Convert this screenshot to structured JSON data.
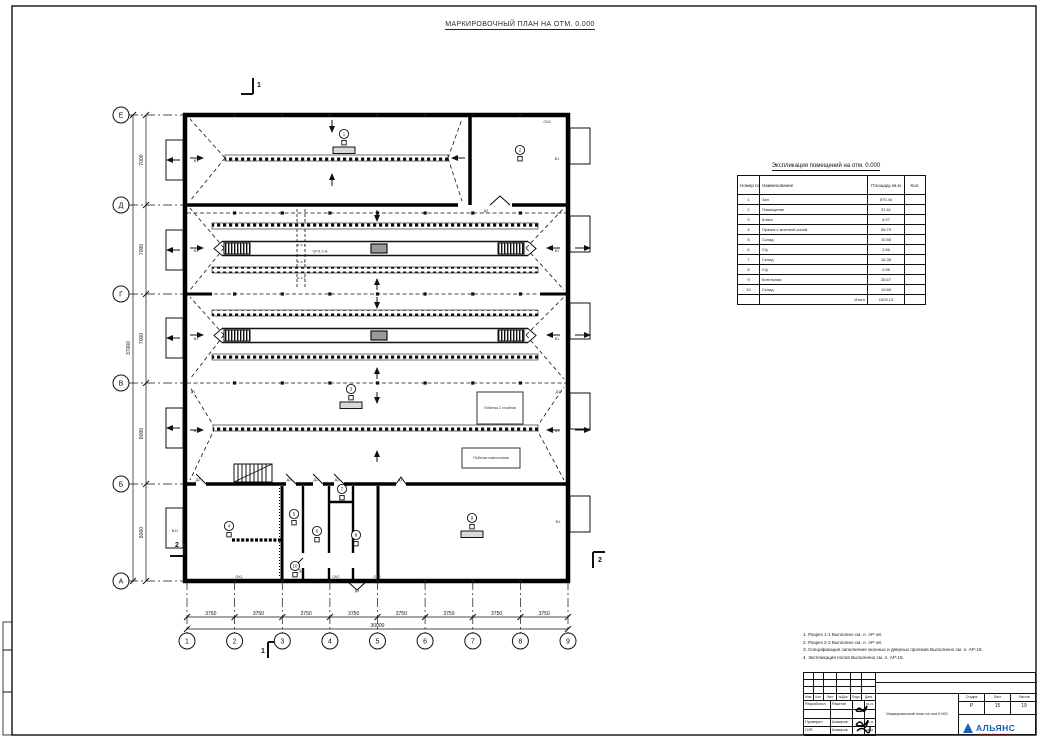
{
  "sheet": {
    "title": "МАРКИРОВОЧНЫЙ ПЛАН НА ОТМ. 0.000"
  },
  "axes": {
    "rows": [
      "Е",
      "Д",
      "Г",
      "В",
      "Б",
      "А"
    ],
    "row_dims": [
      "7000",
      "7000",
      "7000",
      "8000",
      "8000"
    ],
    "row_total": "37000",
    "cols": [
      "1",
      "2",
      "3",
      "4",
      "5",
      "6",
      "7",
      "8",
      "9"
    ],
    "col_dims": [
      "3750",
      "3750",
      "3750",
      "3750",
      "3750",
      "3750",
      "3750",
      "3750"
    ],
    "col_total": "30000"
  },
  "plan": {
    "lane_label": "Q=3.2 м",
    "paint_boxes": [
      {
        "text": "Побелка 2 слойная"
      },
      {
        "text": "Побелка известковая"
      }
    ],
    "room_tags": [
      {
        "num": "1",
        "x": 344,
        "y": 134
      },
      {
        "num": "2",
        "x": 520,
        "y": 150
      },
      {
        "num": "3",
        "x": 351,
        "y": 389
      },
      {
        "num": "4",
        "x": 229,
        "y": 526
      },
      {
        "num": "5",
        "x": 294,
        "y": 514
      },
      {
        "num": "6",
        "x": 317,
        "y": 531
      },
      {
        "num": "7",
        "x": 342,
        "y": 489
      },
      {
        "num": "8",
        "x": 356,
        "y": 535
      },
      {
        "num": "9",
        "x": 472,
        "y": 518
      },
      {
        "num": "10",
        "x": 295,
        "y": 566
      }
    ],
    "annotations": [
      {
        "text": "ОК3",
        "x": 547,
        "y": 123
      },
      {
        "text": "В1",
        "x": 557,
        "y": 160
      },
      {
        "text": "В1",
        "x": 196,
        "y": 162
      },
      {
        "text": "В1",
        "x": 196,
        "y": 252
      },
      {
        "text": "В1",
        "x": 557,
        "y": 252
      },
      {
        "text": "В1",
        "x": 196,
        "y": 340
      },
      {
        "text": "В1",
        "x": 557,
        "y": 340
      },
      {
        "text": "В1",
        "x": 196,
        "y": 432
      },
      {
        "text": "В1",
        "x": 557,
        "y": 432
      },
      {
        "text": "Д1",
        "x": 193,
        "y": 393
      },
      {
        "text": "Д1",
        "x": 558,
        "y": 393
      },
      {
        "text": "Д2",
        "x": 198,
        "y": 481
      },
      {
        "text": "Д3",
        "x": 289,
        "y": 481
      },
      {
        "text": "Д2",
        "x": 316,
        "y": 481
      },
      {
        "text": "Д2",
        "x": 337,
        "y": 481
      },
      {
        "text": "Д4",
        "x": 400,
        "y": 481
      },
      {
        "text": "Д3",
        "x": 486,
        "y": 212
      },
      {
        "text": "В11",
        "x": 175,
        "y": 532
      },
      {
        "text": "В1",
        "x": 558,
        "y": 523
      },
      {
        "text": "ОК1",
        "x": 239,
        "y": 578
      },
      {
        "text": "ОК2",
        "x": 336,
        "y": 578
      },
      {
        "text": "Д4",
        "x": 357,
        "y": 592
      },
      {
        "text": "ОК2",
        "x": 377,
        "y": 578
      },
      {
        "text": "Д5",
        "x": 301,
        "y": 572
      }
    ],
    "section_marks": [
      {
        "text": "1",
        "x": 259,
        "y": 87
      },
      {
        "text": "1",
        "x": 263,
        "y": 653
      },
      {
        "text": "2",
        "x": 177,
        "y": 547
      },
      {
        "text": "2",
        "x": 600,
        "y": 562
      }
    ]
  },
  "explication": {
    "title": "Экспликация помещений на отм. 0.000",
    "headers": [
      "Номер пом.",
      "Наименование",
      "Площадь кв.м",
      "Кол."
    ],
    "rows": [
      {
        "num": "1",
        "name": "Зал",
        "area": "570.44",
        "qty": ""
      },
      {
        "num": "2",
        "name": "Помещение",
        "area": "37.61",
        "qty": ""
      },
      {
        "num": "3",
        "name": "Класс",
        "area": "6.07",
        "qty": ""
      },
      {
        "num": "4",
        "name": "Прачка с моечной зоной",
        "area": "58.79",
        "qty": ""
      },
      {
        "num": "5",
        "name": "Склад",
        "area": "10.56",
        "qty": ""
      },
      {
        "num": "6",
        "name": "С/у",
        "area": "2.66",
        "qty": ""
      },
      {
        "num": "7",
        "name": "Склад",
        "area": "16.38",
        "qty": ""
      },
      {
        "num": "8",
        "name": "С/у",
        "area": "2.96",
        "qty": ""
      },
      {
        "num": "9",
        "name": "Котельная",
        "area": "28.67",
        "qty": ""
      },
      {
        "num": "10",
        "name": "Склад",
        "area": "19.68",
        "qty": ""
      }
    ],
    "total_label": "Итого",
    "total_area": "1009.13"
  },
  "notes": {
    "items": [
      "1. Разрез 1-1 Выполнен см. л. АР-18.",
      "2. Разрез 2-2 Выполнен см. л. АР-18.",
      "3. Спецификация заполнения оконных и дверных проемов Выполнено см. л. АР-19.",
      "4. Экспликация полов Выполнено см. л. АР-15."
    ]
  },
  "stamp": {
    "header_cells": [
      "Изм.",
      "Кол.",
      "Лист",
      "№Док.",
      "Подп.",
      "Дата"
    ],
    "sign_rows": [
      {
        "role": "Разработал",
        "name": "Ракитин",
        "date": "04.21"
      },
      {
        "role": "",
        "name": "",
        "date": ""
      },
      {
        "role": "Проверил",
        "name": "Шакиров",
        "date": "04.21"
      },
      {
        "role": "ГИП",
        "name": "Шакиров",
        "date": "04.21"
      }
    ],
    "doc_title": "Маркировочный план на отм 0.000",
    "stage_label": "Стадия",
    "sheet_label": "Лист",
    "sheets_label": "Листов",
    "stage": "Р",
    "sheet_num": "15",
    "sheets_total": "19",
    "logo": {
      "name": "АЛЬЯНС",
      "subtitle": "строительная компания",
      "color": "#1b5eb5",
      "accent": "#c11e1e"
    }
  }
}
